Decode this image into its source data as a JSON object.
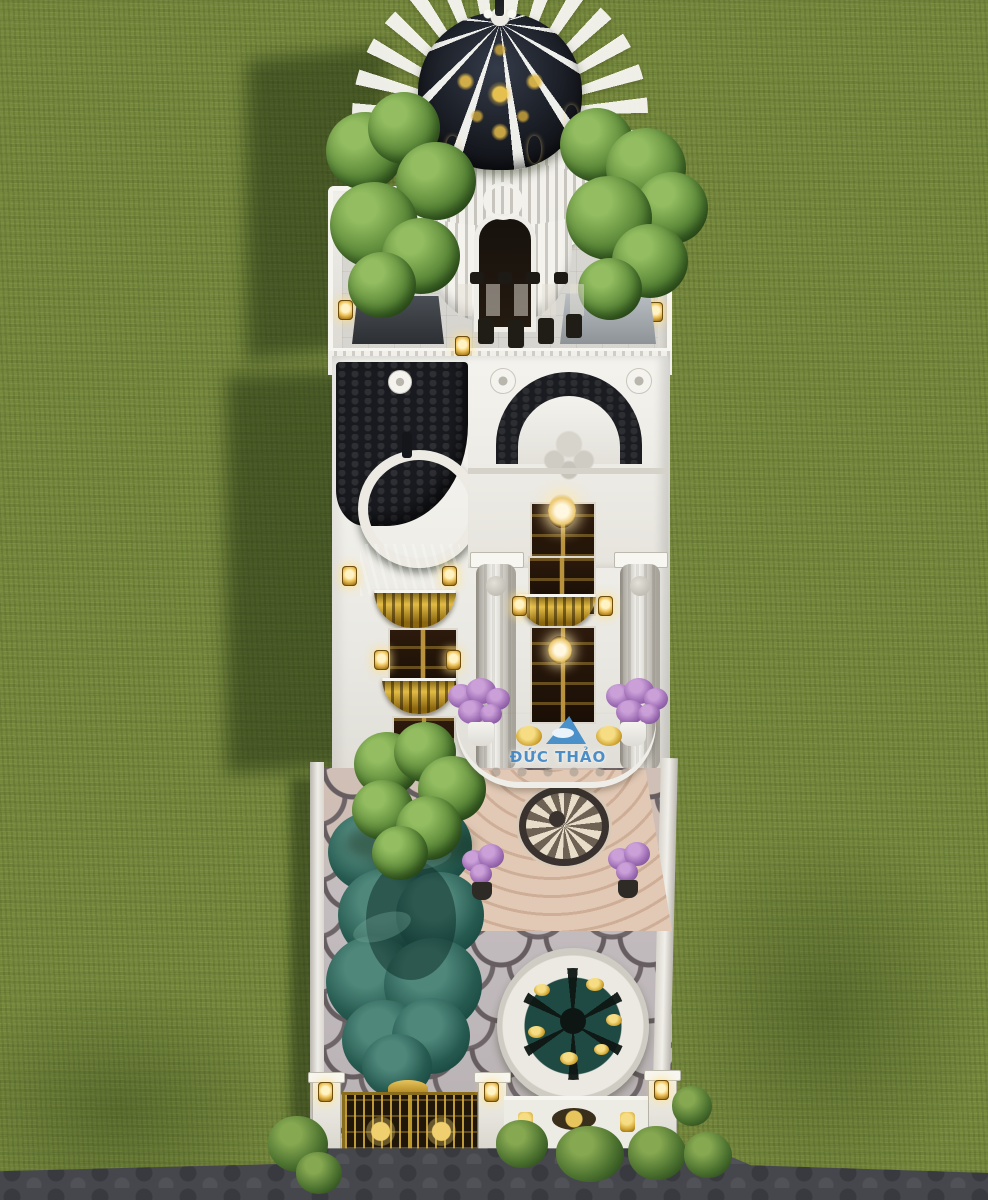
{
  "scene": {
    "description": "Aerial 3D render of a white neoclassical tube-villa on a green lawn: black-and-gold dome tower, rooftop tree terrace, gold balconies, scalloped-paved courtyard with free-form pond, round fountain and gold entry gate",
    "watermark": {
      "text": "ĐỨC THẢO"
    },
    "palette": {
      "grass": "#76883c",
      "grass_shadow": "#2c4416",
      "building_white": "#f2f1ec",
      "roof_dark": "#1a1c21",
      "gold": "#c9a227",
      "lantern_glow": "#ffe9a8",
      "small_dome_teal": "#3f6b61",
      "pond_teal": "#265a50",
      "fountain_water": "#1f4a43",
      "paving_scale": "#c3bcbe",
      "paving_outline": "#665d60",
      "steps_pink": "#d8bca9",
      "door_brown": "#241509",
      "flowers_purple": "#9d6cb4",
      "tree_green": "#5d8a3a",
      "road_cobble": "#46474c",
      "watermark_blue": "#3f86c5"
    }
  }
}
